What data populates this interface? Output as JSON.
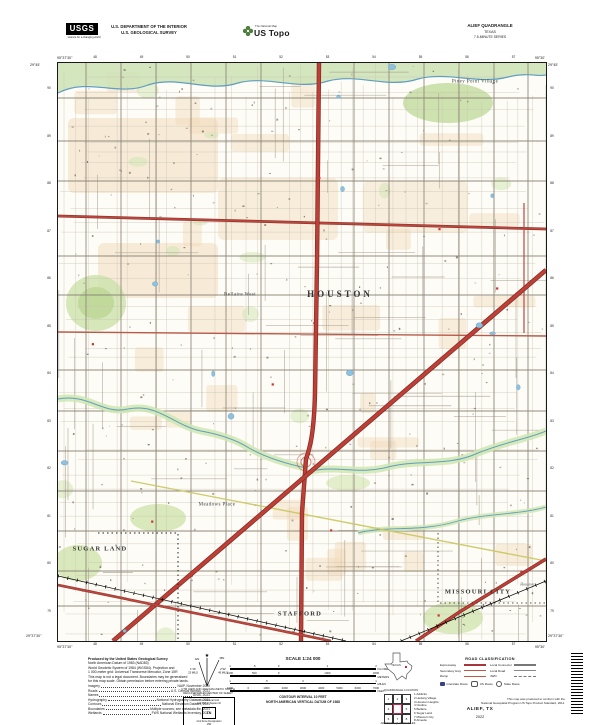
{
  "header": {
    "usgs_logo_text": "USGS",
    "usgs_tagline": "science for a changing world",
    "agency_line1": "U.S. DEPARTMENT OF THE INTERIOR",
    "agency_line2": "U.S. GEOLOGICAL SURVEY",
    "ustopo_small": "The National Map",
    "ustopo_brand": "US Topo",
    "quad_title": "ALIEF QUADRANGLE",
    "quad_state": "TEXAS",
    "quad_series": "7.5-MINUTE SERIES"
  },
  "map": {
    "labels": [
      {
        "text": "HOUSTON",
        "x": 340,
        "y": 294,
        "cls": "city-major"
      },
      {
        "text": "Piney Point Village",
        "x": 475,
        "y": 82,
        "cls": "place"
      },
      {
        "text": "Bellaire West",
        "x": 240,
        "y": 295,
        "cls": "place"
      },
      {
        "text": "SUGAR LAND",
        "x": 100,
        "y": 549,
        "cls": "city-med"
      },
      {
        "text": "Meadows Place",
        "x": 217,
        "y": 505,
        "cls": "place"
      },
      {
        "text": "STAFFORD",
        "x": 300,
        "y": 614,
        "cls": "city-med"
      },
      {
        "text": "MISSOURI CITY",
        "x": 478,
        "y": 592,
        "cls": "city-med"
      },
      {
        "text": "Houston",
        "x": 527,
        "y": 584,
        "cls": "place-tiny"
      }
    ],
    "corner_coords": {
      "top_left_lon": "95°37'30\"",
      "top_left_lat": "29°45'",
      "top_right_lon": "95°30'",
      "top_right_lat": "29°45'",
      "bottom_left_lon": "95°37'30\"",
      "bottom_left_lat": "29°37'30\"",
      "bottom_right_lon": "95°30'",
      "bottom_right_lat": "29°37'30\""
    },
    "edge_ticks": {
      "top": [
        "48",
        "49",
        "50",
        "51",
        "52",
        "53",
        "54",
        "55",
        "56",
        "57"
      ],
      "bottom": [
        "48",
        "49",
        "50",
        "51",
        "52",
        "53",
        "54",
        "55",
        "56",
        "57"
      ],
      "left": [
        "90",
        "89",
        "88",
        "87",
        "86",
        "85",
        "84",
        "83",
        "82",
        "81",
        "80",
        "79"
      ],
      "right": [
        "90",
        "89",
        "88",
        "87",
        "86",
        "85",
        "84",
        "83",
        "82",
        "81",
        "80",
        "79"
      ]
    }
  },
  "footer": {
    "produced_lines": [
      "Produced by the United States Geological Survey",
      "North American Datum of 1983 (NAD83)",
      "World Geodetic System of 1984 (WGS84).  Projection and",
      "1 000-meter grid: Universal Transverse Mercator, Zone 15R",
      "This map is not a legal document. Boundaries may be generalized",
      "for this map scale. Obtain permission before entering private lands."
    ],
    "sources": [
      {
        "label": "Imagery",
        "value": "NAIP, November 2020"
      },
      {
        "label": "Roads",
        "value": "U.S. Census Bureau, 2021"
      },
      {
        "label": "Names",
        "value": "GNIS, 2021"
      },
      {
        "label": "Hydrography",
        "value": "National Hydrography Dataset, 2021"
      },
      {
        "label": "Contours",
        "value": "National Elevation Dataset, 2021"
      },
      {
        "label": "Boundaries",
        "value": "Multiple sources; see metadata file, 2021"
      },
      {
        "label": "Wetlands",
        "value": "FWS National Wetlands Inventory, 2021"
      }
    ],
    "declination": {
      "star": "★",
      "gn_label": "GN",
      "mn_label": "MN",
      "gn_deg": "1°16'",
      "gn_mils": "23 MILS",
      "mn_deg": "2°32'",
      "mn_mils": "45 MILS",
      "caption_line1": "UTM GRID AND 2022 MAGNETIC NORTH",
      "caption_line2": "DECLINATION AT CENTER OF SHEET"
    },
    "usng": {
      "title": "U.S. National Grid",
      "subtitle": "100,000-m Square ID",
      "square_id": "TN",
      "zone_label": "Grid Zone Designation",
      "zone": "15R"
    },
    "scale": {
      "title": "SCALE 1:24 000",
      "bars": [
        {
          "unit": "KILOMETERS",
          "labels": [
            "1",
            ".5",
            "0",
            "1",
            "2"
          ],
          "fracs": [
            0,
            0.167,
            0.333,
            0.667,
            1
          ]
        },
        {
          "unit": "METERS",
          "labels": [
            "1000",
            "500",
            "0",
            "1000",
            "2000"
          ],
          "fracs": [
            0,
            0.167,
            0.333,
            0.667,
            1
          ]
        },
        {
          "unit": "MILES",
          "labels": [
            "1",
            ".5",
            "0",
            "1"
          ],
          "fracs": [
            0,
            0.25,
            0.5,
            1
          ]
        },
        {
          "unit": "FEET",
          "labels": [
            "1000",
            "0",
            "1000",
            "2000",
            "3000",
            "4000",
            "5000",
            "6000",
            "7000"
          ],
          "fracs": [
            0,
            0.125,
            0.25,
            0.375,
            0.5,
            0.625,
            0.75,
            0.875,
            1
          ]
        }
      ],
      "contour_lines": [
        "CONTOUR INTERVAL 10 FEET",
        "NORTH AMERICAN VERTICAL DATUM OF 1988"
      ],
      "conform_lines": [
        "This map was produced to conform with the",
        "National Geospatial Program US Topo Product Standard, 2011."
      ]
    },
    "location": {
      "state": "TEXAS",
      "caption": "QUADRANGLE LOCATION"
    },
    "adjoining": {
      "caption": "ADJOINING QUADRANGLES",
      "grid_numbers": [
        "1",
        "2",
        "3",
        "4",
        "",
        "5",
        "6",
        "7",
        "8"
      ],
      "names": [
        "1 Addicks",
        "2 Hedwig Village",
        "3 Houston Heights",
        "4 Clodine",
        "5 Bellaire",
        "6 Sugar Land",
        "7 Missouri City",
        "8 Almeda"
      ]
    },
    "road_class": {
      "title": "ROAD CLASSIFICATION",
      "rows": [
        {
          "left_label": "Expressway",
          "left_style": "expressway",
          "right_label": "Local Connector",
          "right_style": "local-connector"
        },
        {
          "left_label": "Secondary Hwy",
          "left_style": "secondary",
          "right_label": "Local Road",
          "right_style": "local"
        },
        {
          "left_label": "Ramp",
          "left_style": "ramp",
          "right_label": "4WD",
          "right_style": "fourwd"
        }
      ],
      "shields": [
        {
          "type": "interstate",
          "label": "Interstate Route"
        },
        {
          "type": "us",
          "label": "US Route"
        },
        {
          "type": "state",
          "label": "State Route"
        }
      ]
    },
    "map_name": "ALIEF, TX",
    "year": "2022"
  },
  "colors": {
    "expressway_red": "#bf3f37",
    "secondary_red": "#b85a47",
    "water_blue": "#5f9ec0",
    "vegetation_green": "#cfe3ae",
    "urban_tan": "#f1dab9",
    "interstate_shield_blue": "#3b3f8c"
  }
}
